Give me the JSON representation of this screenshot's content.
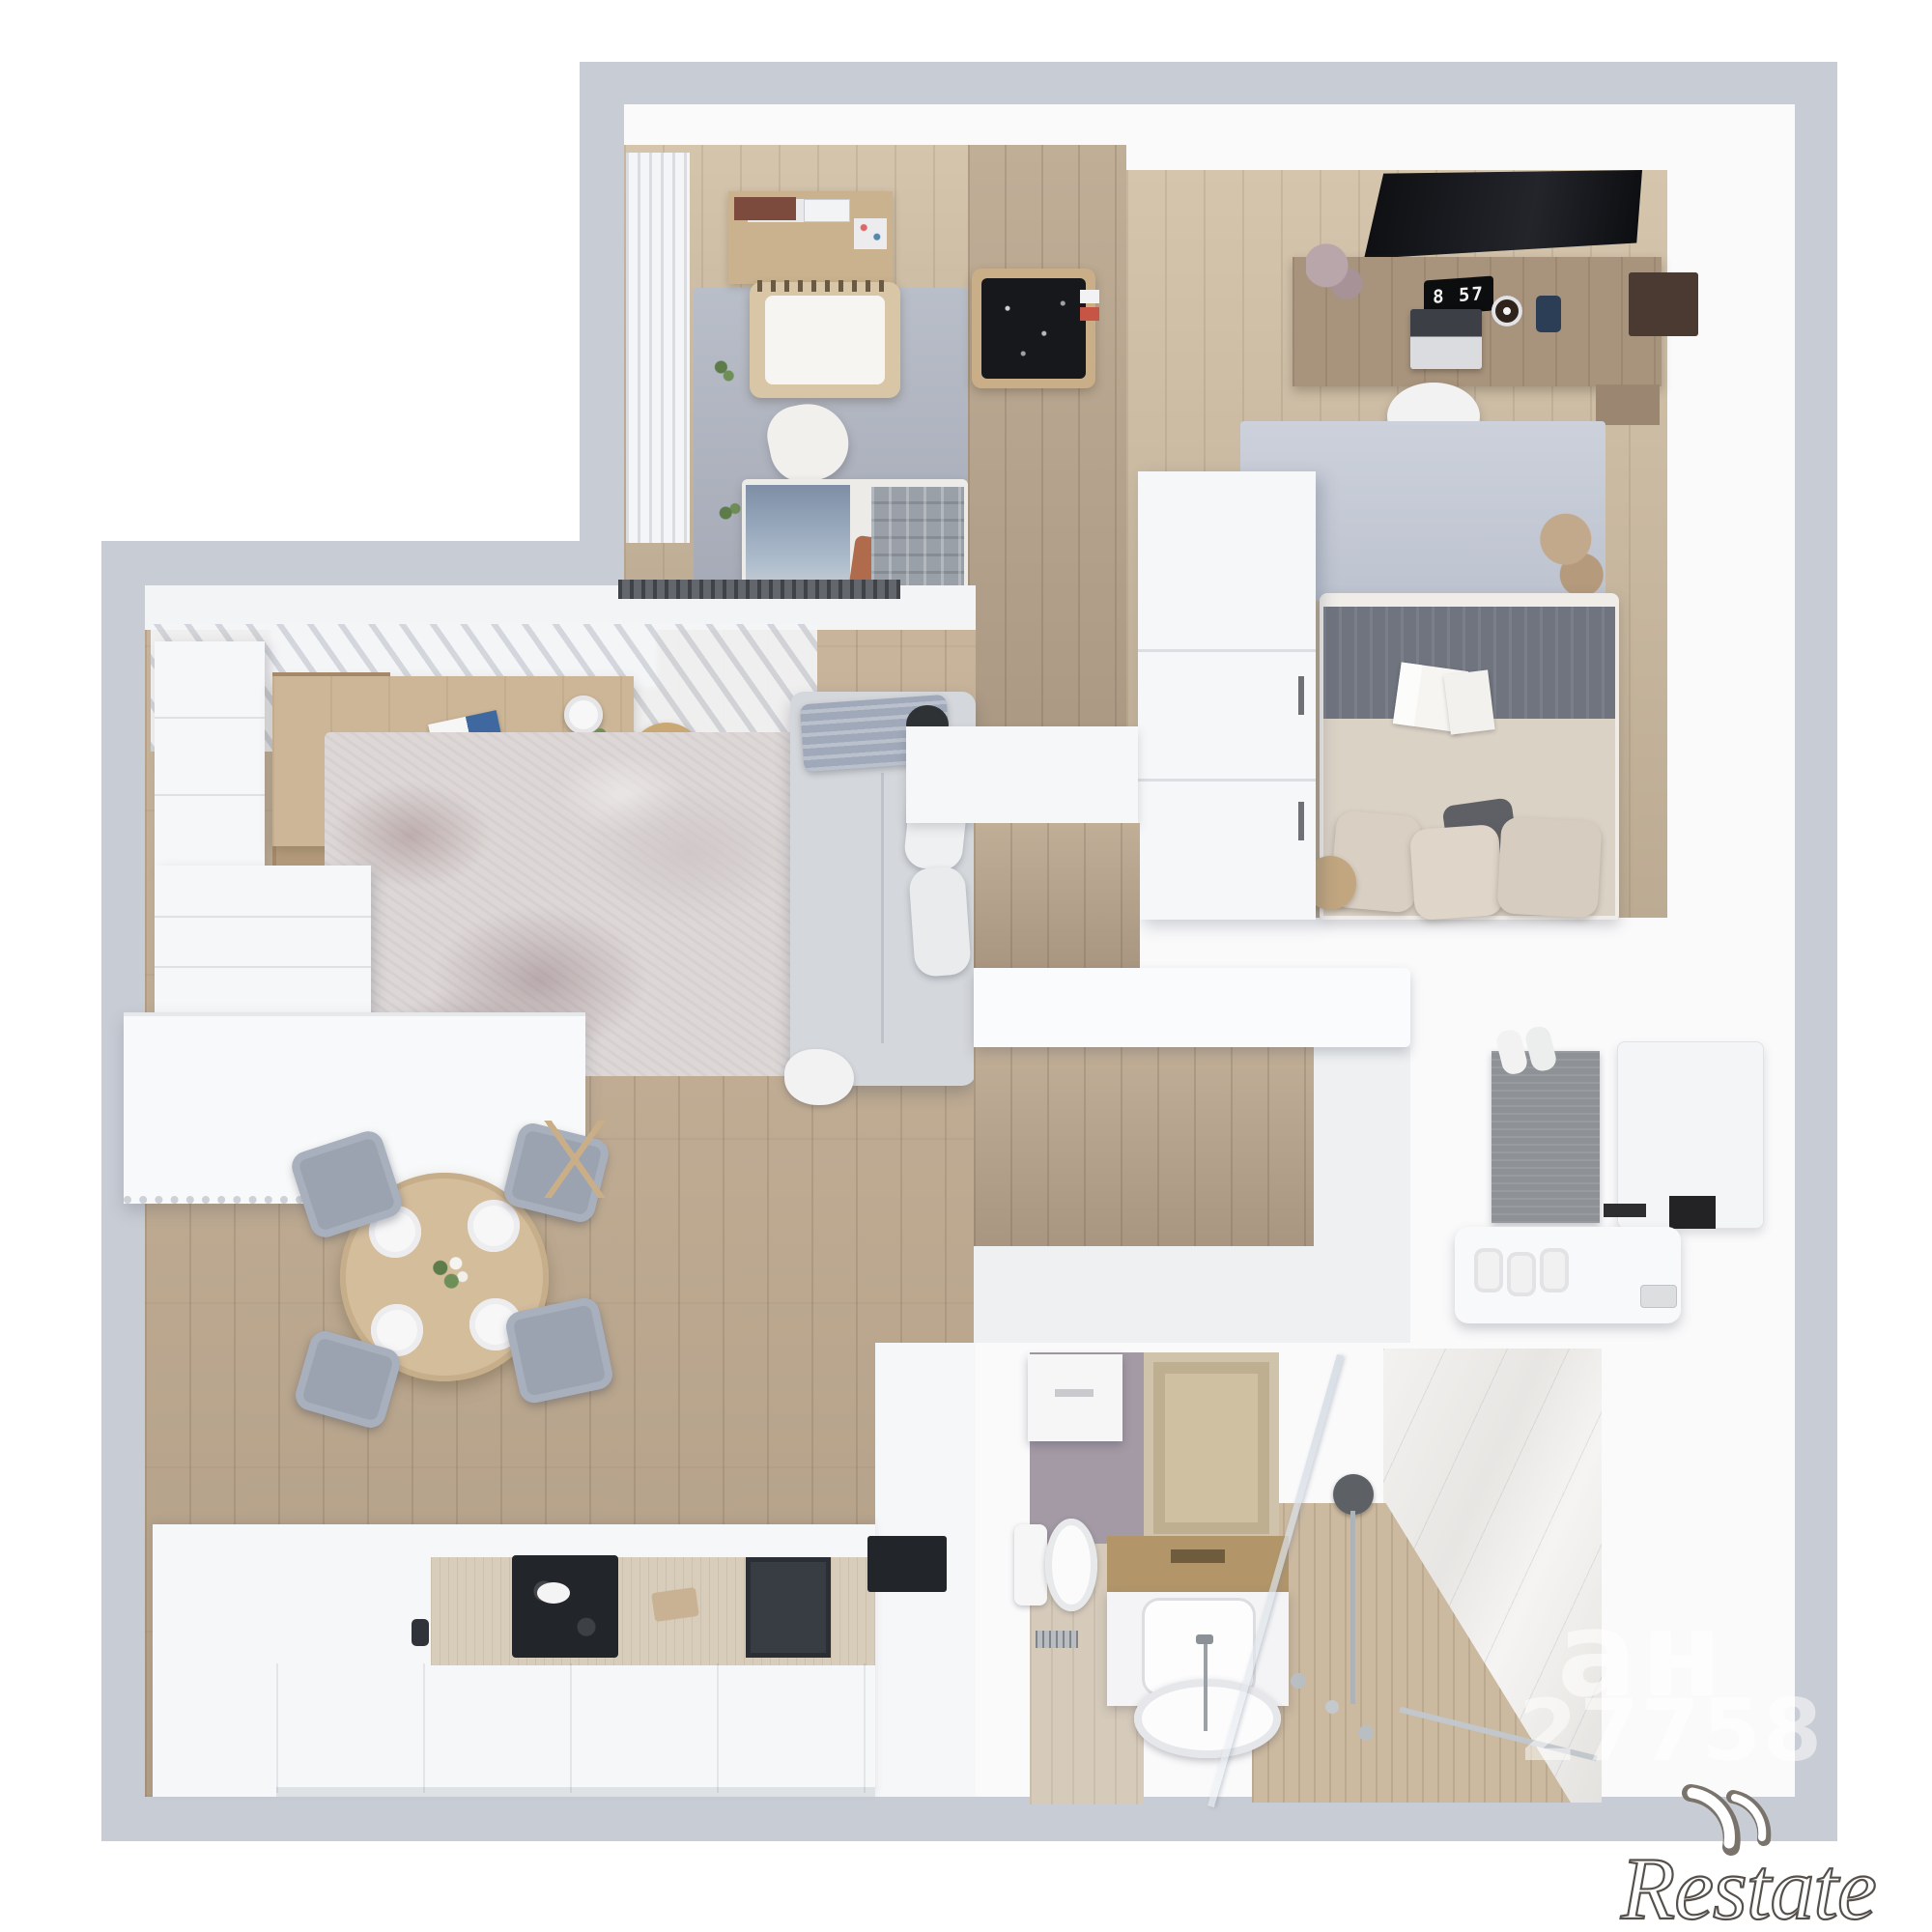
{
  "bedroom": {
    "clock_time": "8 57"
  },
  "watermarks": {
    "cyrillic_fragment": "ан",
    "id_fragment": "27758",
    "logo": "Restate"
  },
  "palette": {
    "background": "#ffffff",
    "ground_gray": "#c8cdd5",
    "wall_white": "#fafafb",
    "wood_floor": "#bfa98e",
    "corridor_wood": "#b7a48c",
    "bedroom_rug": "#ccd1db",
    "nursery_rug": "#b0b5c0",
    "sofa_gray": "#d4d7db",
    "desk_wood": "#ccb697",
    "table_wood": "#d4bd9b",
    "chair_gray": "#9ba3b1",
    "tub_rim_gold": "#b2966a",
    "bathroom_wall_purple": "#a39aa5",
    "mat_beige": "#cfc1a2",
    "tv_black": "#101114",
    "marble": "#eceae7"
  }
}
